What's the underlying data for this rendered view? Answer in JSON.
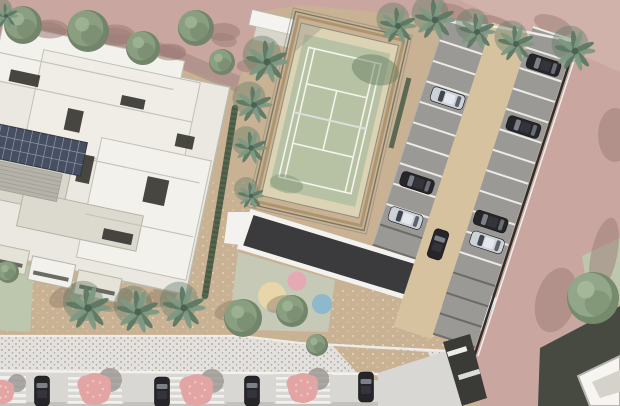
{
  "scene": {
    "title": "Aerial 3D site plan render: residential complex with tennis court, lap pool, playground, parking lot and tree-lined street",
    "inventory": {
      "buildings": 3,
      "tennis_courts": 1,
      "lap_pools": 1,
      "playground_circles": 3,
      "parking_lot_cars": 8,
      "street_cars": 4,
      "palm_trees": 13,
      "round_trees_top": 5,
      "pink_flowering_trees": 4
    },
    "colors": {
      "road_pink": "#c9a7a0",
      "road_pink_light": "#d7bbb3",
      "road_shadow": "#9c7c76",
      "ground_tan": "#c9b294",
      "aisle_tan": "#d6c29e",
      "stall_gray": "#9b9995",
      "stall_line": "#ecebe7",
      "stall_line_dark": "#63625e",
      "court_green": "#b7c2a5",
      "court_line": "#f4f4ec",
      "court_frame": "#a8906a",
      "court_deck": "#dcd2b4",
      "pool_dark": "#3b3a3c",
      "deck_white": "#f3f2ee",
      "pad_green": "#c5c9b6",
      "circle_sand": "#e9d7aa",
      "circle_pink": "#e7a8b3",
      "circle_blue": "#8bb8cd",
      "roof_white": "#eae8e1",
      "roof_bright": "#f3f1eb",
      "roof_shade": "#d9d6cc",
      "roof_edge": "#b7b4a9",
      "inset_dark": "#383732",
      "solar_panel": "#465062",
      "deck_gray": "#b4b2a9",
      "hedge_green": "#50614a",
      "grass_green": "#bdc7ae",
      "palm_green": "#7d9983",
      "palm_dark": "#5d7863",
      "tree_olive": "#8a9e80",
      "tree_olive_dark": "#72856a",
      "tree_olive_light": "#9db193",
      "tree_big": "#92a789",
      "tree_pink": "#e3a4a4",
      "tree_pink_light": "#f0c6c3",
      "sidewalk_gray": "#e2e1dd",
      "street_gray": "#d8d7d4",
      "curb_white": "#f3f2ef",
      "car_dark": "#26262a",
      "car_silver": "#cdd2d9",
      "car_glass": "#7b8089",
      "dark_building": "#464a40",
      "white_building": "#f6f5f1",
      "fence_dark": "#2e2e2c"
    },
    "trees": {
      "round_top": [
        [
          23,
          25,
          19
        ],
        [
          88,
          31,
          21
        ],
        [
          143,
          48,
          17
        ],
        [
          196,
          28,
          18
        ],
        [
          222,
          62,
          13
        ]
      ],
      "palms": [
        [
          267,
          62,
          21
        ],
        [
          254,
          105,
          18
        ],
        [
          251,
          148,
          16
        ],
        [
          251,
          196,
          13
        ],
        [
          398,
          26,
          18
        ],
        [
          435,
          20,
          20
        ],
        [
          477,
          32,
          18
        ],
        [
          516,
          44,
          18
        ],
        [
          575,
          51,
          20
        ],
        [
          88,
          308,
          22
        ],
        [
          138,
          312,
          21
        ],
        [
          184,
          308,
          21
        ],
        [
          6,
          16,
          12
        ]
      ],
      "olive": [
        [
          243,
          318,
          19
        ],
        [
          292,
          311,
          16
        ],
        [
          317,
          345,
          11
        ],
        [
          8,
          272,
          11
        ]
      ],
      "big_right": [
        593,
        298,
        26
      ],
      "pink_street": [
        [
          2,
          392,
          12
        ],
        [
          95,
          389,
          16
        ],
        [
          197,
          390,
          16
        ],
        [
          303,
          388,
          15
        ]
      ]
    },
    "road_shadows": [
      [
        50,
        30,
        16,
        8,
        10
      ],
      [
        118,
        36,
        16,
        8,
        10
      ],
      [
        172,
        52,
        14,
        7,
        10
      ],
      [
        224,
        40,
        13,
        7,
        10
      ],
      [
        455,
        12,
        18,
        7,
        20
      ],
      [
        497,
        24,
        18,
        7,
        20
      ],
      [
        553,
        25,
        20,
        9,
        20
      ],
      [
        615,
        135,
        17,
        27,
        0
      ],
      [
        604,
        255,
        13,
        38,
        12
      ],
      [
        556,
        300,
        20,
        33,
        16
      ]
    ],
    "plaza_shadows": [
      [
        66,
        296,
        18,
        10,
        -25
      ],
      [
        116,
        300,
        18,
        10,
        -25
      ],
      [
        162,
        296,
        17,
        10,
        -25
      ],
      [
        230,
        310,
        16,
        9,
        -20
      ],
      [
        280,
        304,
        14,
        8,
        -20
      ]
    ],
    "parking": {
      "rows": {
        "left": {
          "x1": 417,
          "x2": 462,
          "y0": 22,
          "pitch": 21.5,
          "count": 12,
          "dark_from": 10
        },
        "right": {
          "x1": 502,
          "x2": 546,
          "y0": 2,
          "pitch": 21.5,
          "count": 16,
          "dark_from": 12
        }
      },
      "cars": [
        [
          443,
          96,
          "silver",
          "h"
        ],
        [
          440,
          186,
          "dark",
          "h"
        ],
        [
          440,
          223,
          "silver",
          "h"
        ],
        [
          524,
          35,
          "dark",
          "h"
        ],
        [
          524,
          100,
          "dark",
          "h"
        ],
        [
          522,
          200,
          "dark",
          "h"
        ],
        [
          525,
          221,
          "silver",
          "h"
        ],
        [
          479,
          238,
          "dark",
          "v"
        ]
      ]
    },
    "street": {
      "cars": [
        [
          42,
          375
        ],
        [
          162,
          376
        ],
        [
          252,
          375
        ],
        [
          366,
          371
        ]
      ],
      "pits": [
        95,
        197,
        303
      ],
      "zebra": {
        "x": 0,
        "y": 376,
        "w": 26,
        "stripes": 5
      },
      "curb_y": 371
    },
    "playground": {
      "circles": [
        [
          272,
          296,
          14,
          "circle_sand"
        ],
        [
          297,
          281,
          9.5,
          "circle_pink"
        ],
        [
          322,
          304,
          10,
          "circle_blue"
        ]
      ]
    },
    "building": {
      "insets": [
        [
          -8,
          90,
          30,
          12
        ],
        [
          56,
          116,
          16,
          22
        ],
        [
          106,
          92,
          24,
          10
        ],
        [
          148,
          166,
          22,
          26
        ],
        [
          36,
          198,
          28,
          12
        ],
        [
          116,
          226,
          30,
          11
        ],
        [
          168,
          118,
          18,
          13
        ],
        [
          78,
          158,
          14,
          28
        ]
      ],
      "balconies": [
        [
          -44,
          260
        ],
        [
          4,
          264
        ],
        [
          52,
          268
        ],
        [
          100,
          272
        ]
      ],
      "steps": [
        [
          -30,
          104,
          180,
          104
        ],
        [
          20,
          162,
          200,
          162
        ],
        [
          95,
          216,
          205,
          216
        ],
        [
          -25,
          76,
          155,
          76
        ]
      ],
      "solar": {
        "x": -14,
        "y": 146,
        "w": 96,
        "h": 34,
        "cols": 12,
        "rows": 3
      },
      "deck": {
        "x": -40,
        "y": 182,
        "w": 104,
        "h": 28,
        "slats": 7
      }
    }
  }
}
